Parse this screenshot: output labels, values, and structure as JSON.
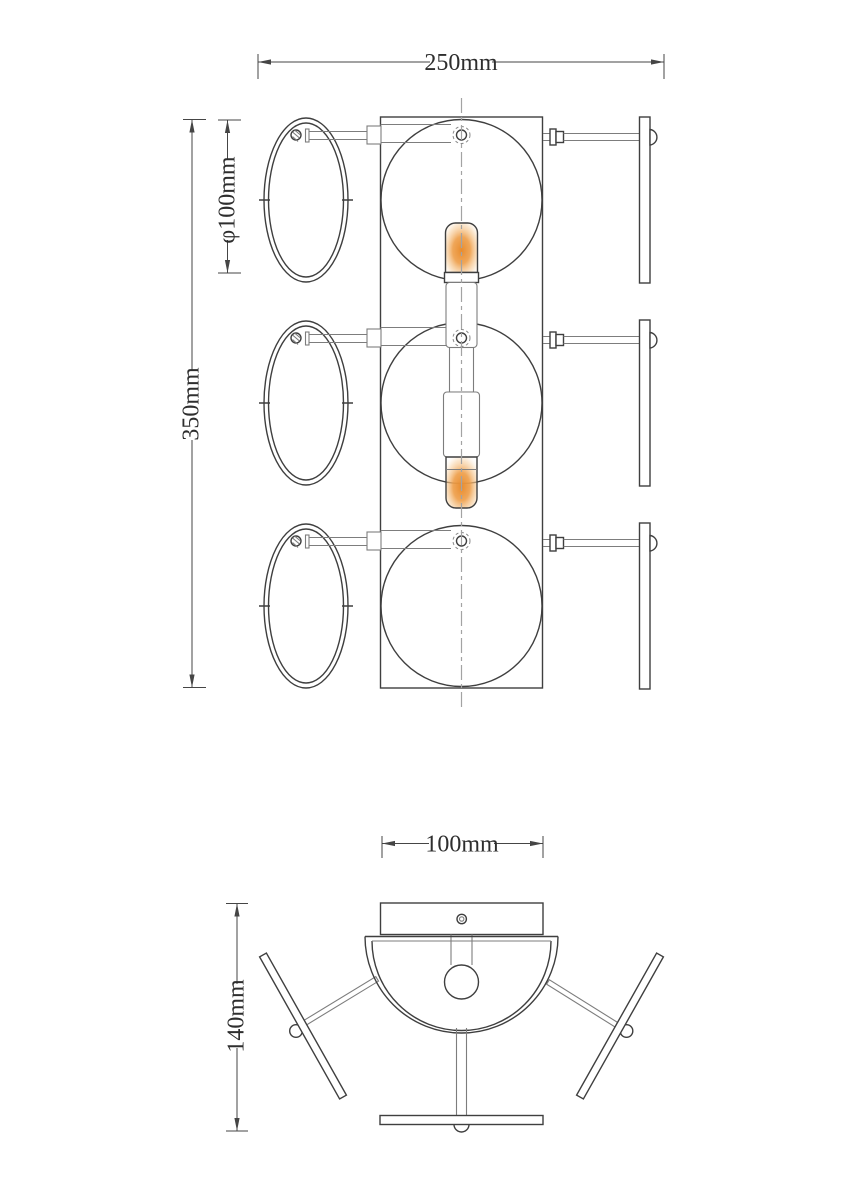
{
  "palette": {
    "background": "#ffffff",
    "line": "#3f3f3f",
    "light_line": "#7d7d7d",
    "centerline": "#a3a3a3",
    "dimension": "#454545",
    "glow_core": "#e88c2e",
    "glow_mid": "#f0a95c",
    "glow_edge": "#ffffff"
  },
  "front_view": {
    "dimensions": {
      "overall_width": {
        "label": "250mm"
      },
      "shade_diameter": {
        "label": "φ100mm"
      },
      "overall_height": {
        "label": "350mm"
      }
    }
  },
  "top_view": {
    "dimensions": {
      "canopy_width": {
        "label": "100mm"
      },
      "overall_depth": {
        "label": "140mm"
      }
    }
  }
}
